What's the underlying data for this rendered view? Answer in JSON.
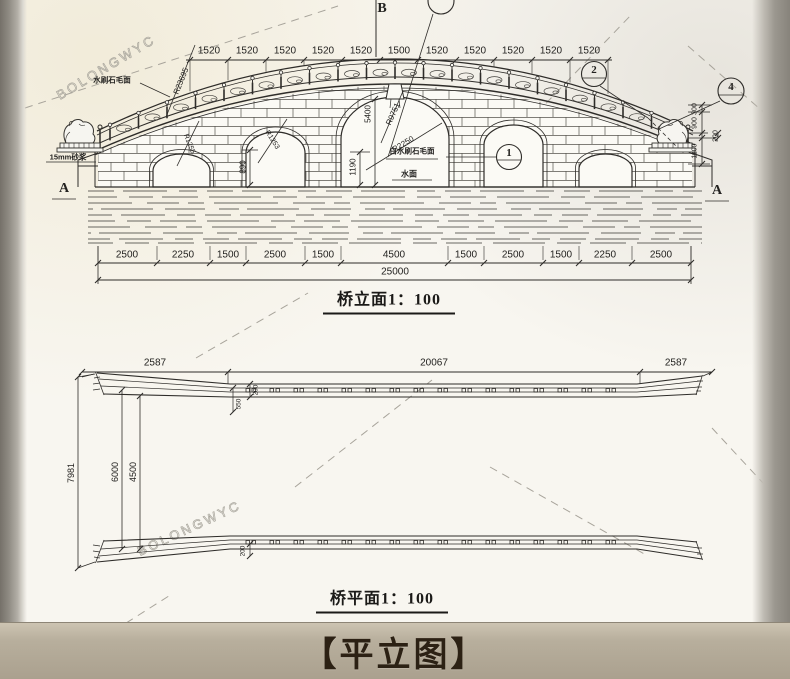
{
  "page": {
    "caption": "【平立图】"
  },
  "watermark": "BOLONGWYC",
  "elevation": {
    "title": "桥立面1：100",
    "top_dims": [
      "1520",
      "1520",
      "1520",
      "1520",
      "1520",
      "1500",
      "1520",
      "1520",
      "1520",
      "1520",
      "1520"
    ],
    "bottom_dims": [
      "2500",
      "2250",
      "1500",
      "2500",
      "1500",
      "4500",
      "1500",
      "2500",
      "1500",
      "2250",
      "2500"
    ],
    "total_dim": "25000",
    "height_dims": {
      "arch_center": "5400",
      "water_clear": "1190",
      "side_arch": "890",
      "right_300": "300",
      "right_900": "900",
      "right_200": "200",
      "right_1100": "1100"
    },
    "radius_labels": {
      "deck": "R23695",
      "center_outer": "R9751",
      "center_inner": "R2250",
      "left_small": "R1255",
      "right_small": "R1253"
    },
    "notes": {
      "surface_left": "水刷石毛面",
      "mortar": "15mm砂浆",
      "surface_center": "白水刷石毛面",
      "water_level": "水面"
    },
    "section_marks": {
      "top": "B",
      "left": "A",
      "right": "A"
    },
    "balloons": {
      "b1": "1",
      "b2": "2",
      "b4": "4"
    }
  },
  "plan": {
    "title": "桥平面1：100",
    "top_dims": [
      "2587",
      "20067",
      "2587"
    ],
    "left_dims": [
      "7981",
      "6000",
      "4500"
    ],
    "detail_dims": {
      "rail_width": "200",
      "rail_offset": "550",
      "rail_width_bottom": "200"
    }
  }
}
